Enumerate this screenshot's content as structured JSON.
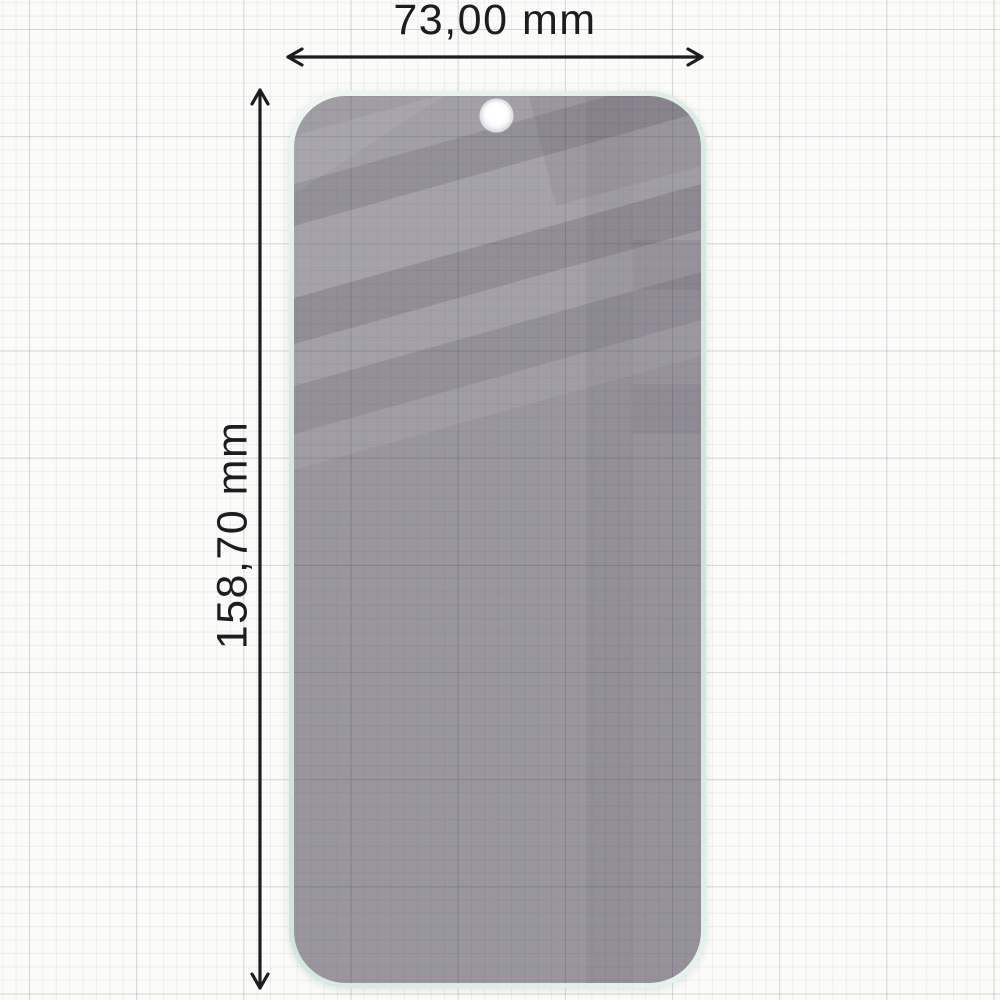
{
  "diagram": {
    "subject": "privacy-screen-protector",
    "width_dimension": {
      "label": "73,00 mm",
      "value": "73,00",
      "unit": "mm"
    },
    "height_dimension": {
      "label": "158,70 mm",
      "value": "158,70",
      "unit": "mm"
    }
  },
  "icons": {
    "camera_cutout": "camera-hole-icon",
    "width_arrow": "horizontal-double-arrow-icon",
    "height_arrow": "vertical-double-arrow-icon"
  },
  "colors": {
    "paper_background": "#fbfbf9",
    "grid_line_fine": "#ebebec",
    "grid_line_major": "#d8d8da",
    "glass_surface_tint": "#99969e",
    "glass_edge_mint": "#d6e9e0",
    "reflection_light": "#ffffff",
    "reflection_dark": "#3a3846",
    "dimension_line": "#1d1d1f",
    "label_text": "#1d1d1f",
    "camera_hole": "#ffffff"
  }
}
